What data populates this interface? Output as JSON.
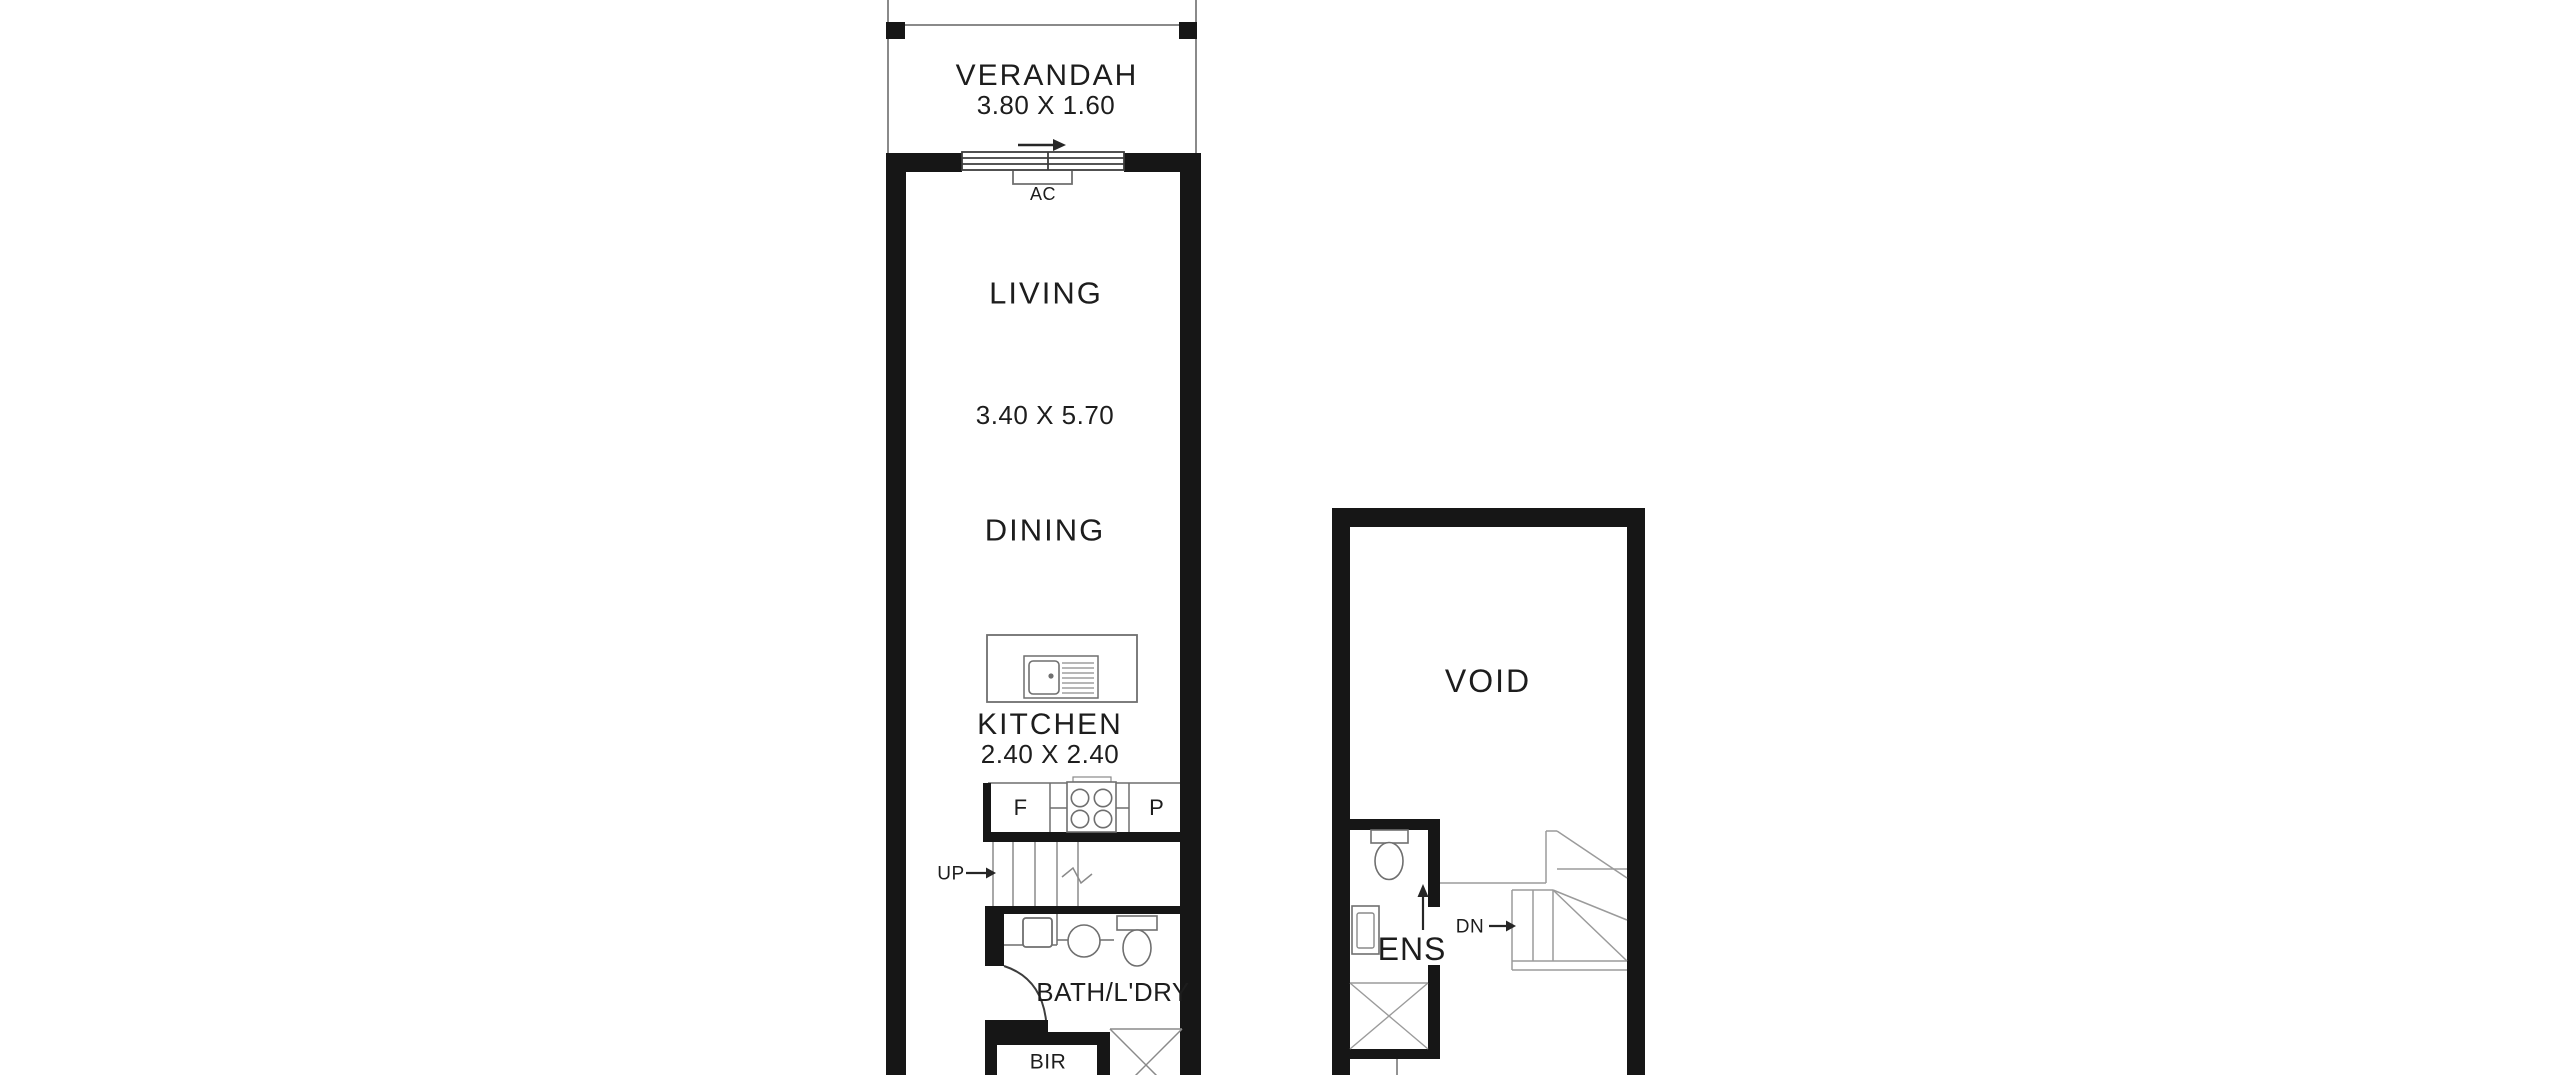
{
  "colors": {
    "background": "#ffffff",
    "walls": "#161616",
    "thin_lines": "#7a7a7a",
    "text": "#1d1d1d"
  },
  "plan": {
    "left_unit": {
      "verandah": {
        "name": "VERANDAH",
        "size": "3.80 X 1.60"
      },
      "ac_unit": {
        "label": "AC"
      },
      "living": {
        "name": "LIVING"
      },
      "living_dining_size": "3.40 X 5.70",
      "dining": {
        "name": "DINING"
      },
      "kitchen": {
        "name": "KITCHEN",
        "size": "2.40 X 2.40",
        "fridge": "F",
        "pantry": "P"
      },
      "stairs": {
        "direction": "UP"
      },
      "bath_laundry": {
        "name": "BATH/L'DRY"
      },
      "built_in_robe": {
        "name": "BIR"
      }
    },
    "right_unit": {
      "void": {
        "name": "VOID"
      },
      "ensuite": {
        "name": "ENS"
      },
      "stairs": {
        "direction": "DN"
      }
    }
  }
}
